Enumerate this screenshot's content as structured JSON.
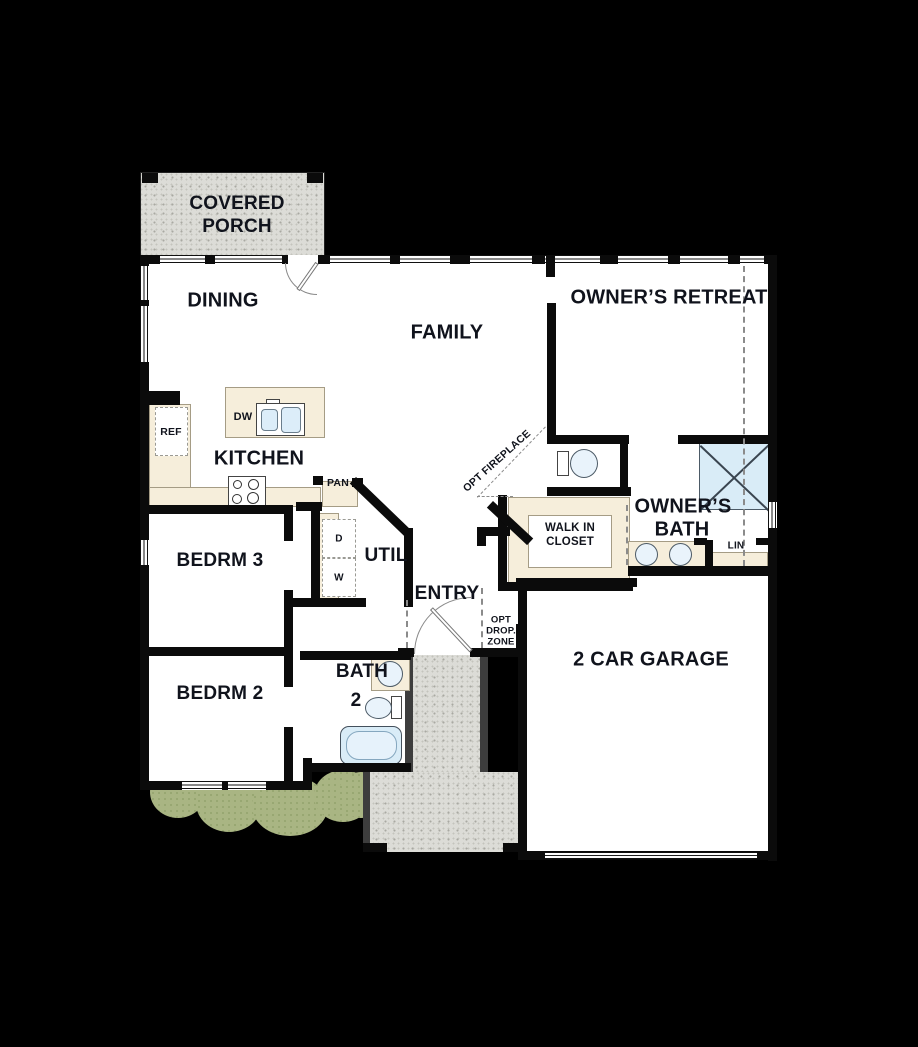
{
  "labels": {
    "covered_porch_1": "COVERED",
    "covered_porch_2": "PORCH",
    "dining": "DINING",
    "family": "FAMILY",
    "owners_retreat": "OWNER’S RETREAT",
    "kitchen": "KITCHEN",
    "bedrm3": "BEDRM 3",
    "bedrm2": "BEDRM 2",
    "util": "UTIL",
    "entry": "ENTRY",
    "bath2_1": "BATH",
    "bath2_2": "2",
    "walk_in_closet_1": "WALK IN",
    "walk_in_closet_2": "CLOSET",
    "owners_bath_1": "OWNER’S",
    "owners_bath_2": "BATH",
    "garage": "2 CAR GARAGE",
    "ref": "REF",
    "dw": "DW",
    "pan": "PAN",
    "dryer": "D",
    "washer": "W",
    "lin": "LIN",
    "opt_fireplace": "OPT FIREPLACE",
    "drop_zone_1": "OPT",
    "drop_zone_2": "DROP.",
    "drop_zone_3": "ZONE"
  },
  "colors": {
    "background": "#000000",
    "floor": "#ffffff",
    "wall": "#0b0b0b",
    "counter": "#f6eedb",
    "porch_concrete": "#dcdcd7",
    "water_fixture": "#d9ecf7",
    "landscape_green": "#a9b583",
    "dashed_gray": "#8b8b8b",
    "label_text": "#10131c"
  }
}
